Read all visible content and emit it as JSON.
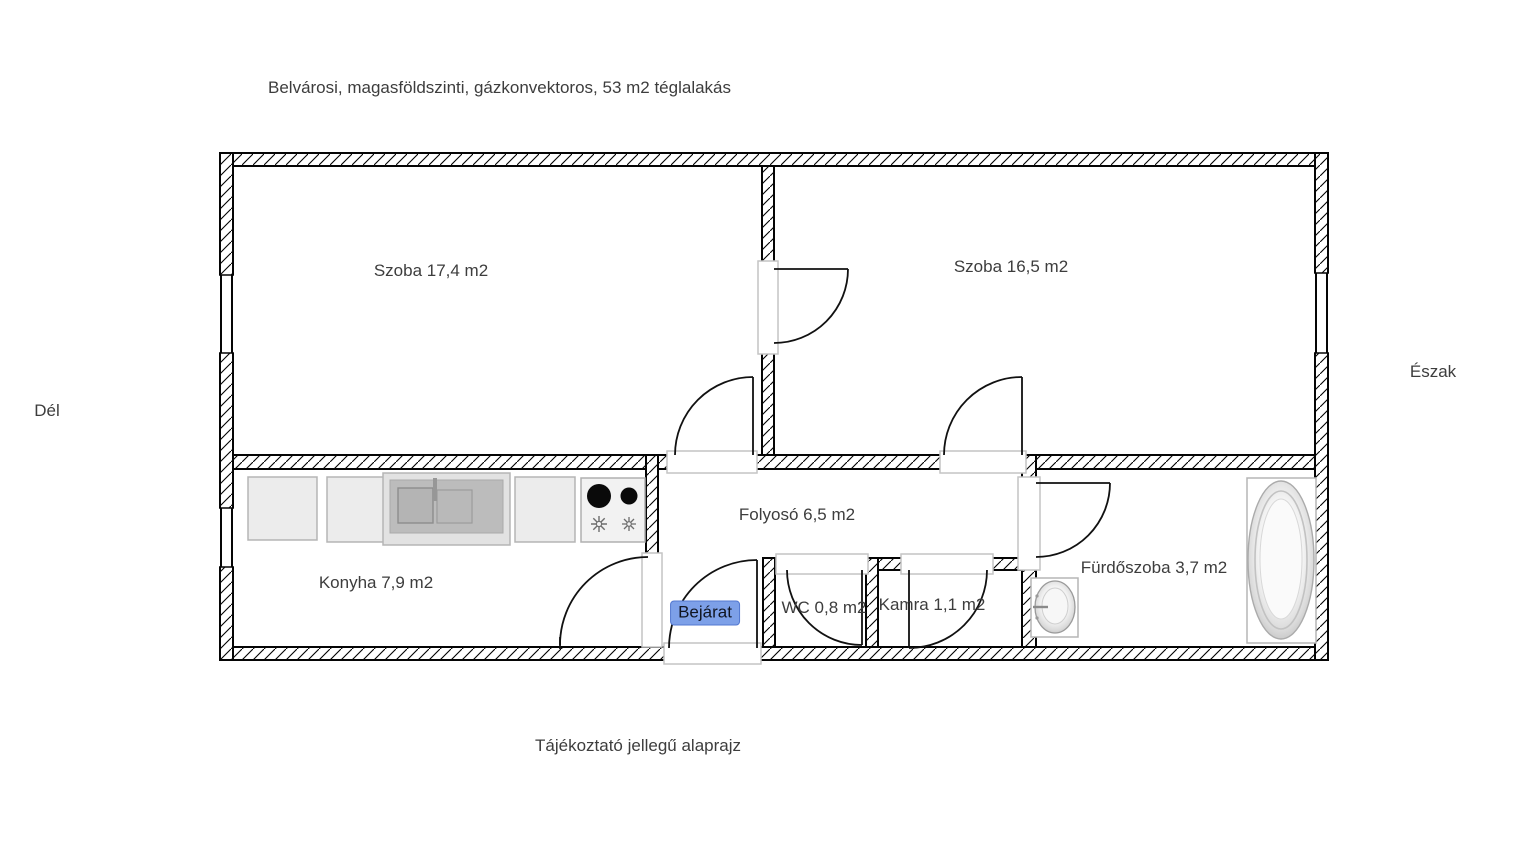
{
  "page": {
    "title": "Belvárosi, magasföldszinti, gázkonvektoros, 53 m2 téglalakás",
    "footer_note": "Tájékoztató jellegű alaprajz"
  },
  "compass": {
    "south_label": "Dél",
    "north_label": "Észak"
  },
  "floor_plan": {
    "rooms": [
      {
        "name": "szoba-1",
        "label": "Szoba 17,4 m2"
      },
      {
        "name": "szoba-2",
        "label": "Szoba 16,5 m2"
      },
      {
        "name": "konyha",
        "label": "Konyha 7,9 m2"
      },
      {
        "name": "folyoso",
        "label": "Folyosó 6,5 m2"
      },
      {
        "name": "wc",
        "label": "WC 0,8 m2"
      },
      {
        "name": "kamra",
        "label": "Kamra 1,1 m2"
      },
      {
        "name": "furdoszoba",
        "label": "Fürdőszoba 3,7 m2"
      }
    ],
    "entrance": {
      "label": "Bejárat",
      "highlight_color": "#7da0e8",
      "border_color": "#5277d0",
      "text_color": "#101522"
    },
    "fixtures": [
      "kitchen-cabinet-1",
      "kitchen-cabinet-2",
      "kitchen-sink",
      "kitchen-cabinet-3",
      "gas-stove",
      "bathroom-sink",
      "bathtub"
    ],
    "colors": {
      "wall_line": "#000000",
      "door_jamb_gray": "#c4c4c4",
      "fixture_gray": "#bcbcbc",
      "label_text": "#3d3d3d"
    }
  }
}
